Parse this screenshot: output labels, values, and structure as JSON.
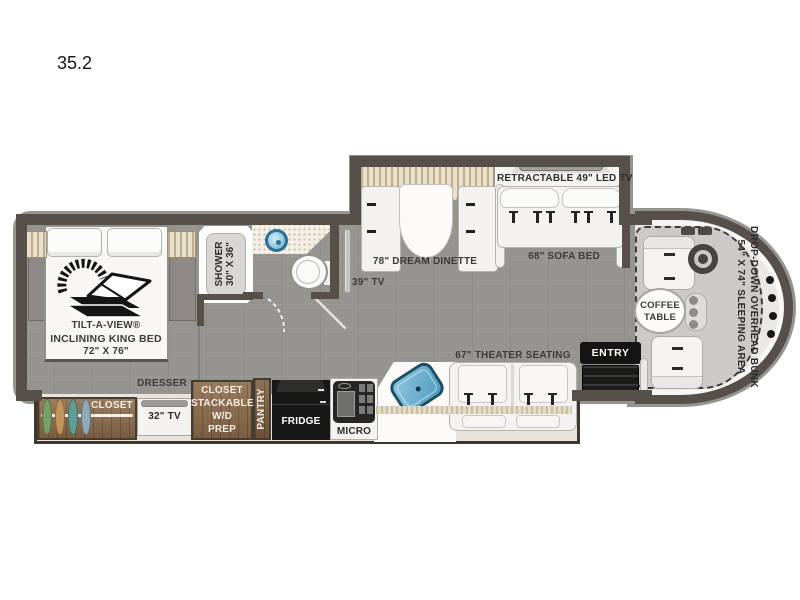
{
  "model": "35.2",
  "bedroom": {
    "bed_line1": "TILT-A-VIEW®",
    "bed_line2": "INCLINING KING BED",
    "bed_line3": "72\" X 76\"",
    "dresser": "DRESSER",
    "closet": "CLOSET",
    "tv": "32\" TV"
  },
  "bathroom": {
    "shower_line1": "SHOWER",
    "shower_line2": "30\" X 36\""
  },
  "hall": {
    "tv": "39\" TV",
    "wd_line1": "CLOSET",
    "wd_line2": "STACKABLE",
    "wd_line3": "W/D",
    "wd_line4": "PREP",
    "pantry": "PANTRY"
  },
  "kitchen": {
    "fridge": "FRIDGE",
    "micro": "MICRO"
  },
  "living": {
    "dinette": "78\" DREAM DINETTE",
    "retractable_tv": "RETRACTABLE 49\" LED TV",
    "sofa": "68\" SOFA BED",
    "theater": "67\" THEATER SEATING",
    "entry": "ENTRY"
  },
  "cab": {
    "coffee_line1": "COFFEE",
    "coffee_line2": "TABLE",
    "bunk_line1": "DROP-DOWN OVERHEAD BUNK",
    "bunk_line2": "54\" X 74\" SLEEPING AREA"
  },
  "colors": {
    "wall": "#574f49",
    "floor": "#96948e",
    "wood": "#8c6a4a",
    "slide_interior": "#e9e4db",
    "sink_blue": "#5aa8cc",
    "appliance_black": "#181818",
    "cab_floor": "#cbcac6",
    "windshield": "#e9e8e5",
    "hanger_green": "#76a065",
    "hanger_tan": "#c2955c",
    "hanger_teal": "#5f9e94",
    "hanger_blue": "#8fa9b8"
  }
}
